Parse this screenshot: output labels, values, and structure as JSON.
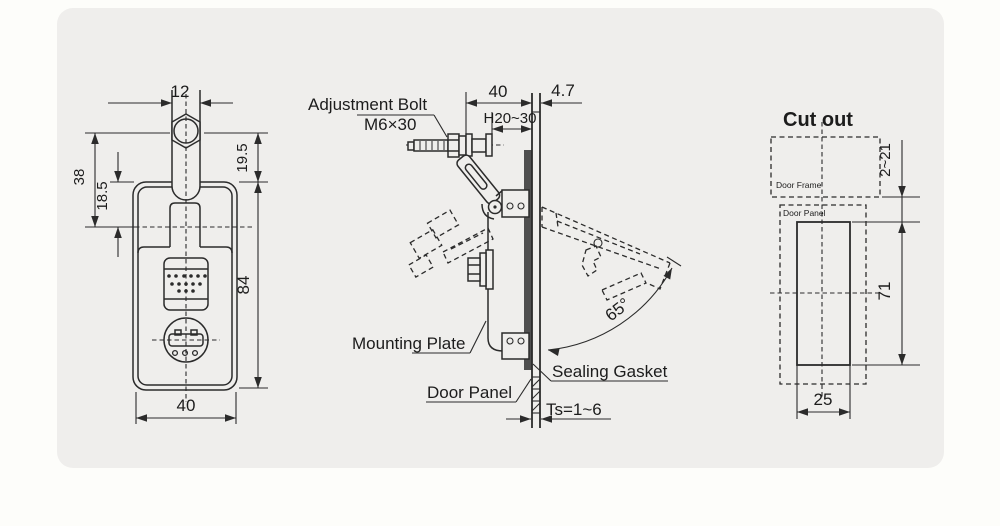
{
  "colors": {
    "line": "#2b2b2b",
    "panel_background": "#efeeec",
    "page_background": "#fdfdfa",
    "gasket": "#4f4f4f"
  },
  "front": {
    "shaft_width": "12",
    "hex_to_body": "19.5",
    "hex_to_center": "38",
    "body_to_center": "18.5",
    "body_height": "84",
    "body_width": "40"
  },
  "side": {
    "adjustment_bolt": "Adjustment Bolt",
    "bolt_spec": "M6×30",
    "depth": "40",
    "grip": "H20~30",
    "protrusion": "4.7",
    "open_angle": "65°",
    "mounting_plate": "Mounting Plate",
    "door_panel": "Door Panel",
    "sealing_gasket": "Sealing Gasket",
    "panel_thickness": "Ts=1~6"
  },
  "cutout": {
    "title": "Cut out",
    "door_frame": "Door Frame",
    "door_panel": "Door Panel",
    "edge_distance": "2~21",
    "height": "71",
    "width": "25"
  }
}
